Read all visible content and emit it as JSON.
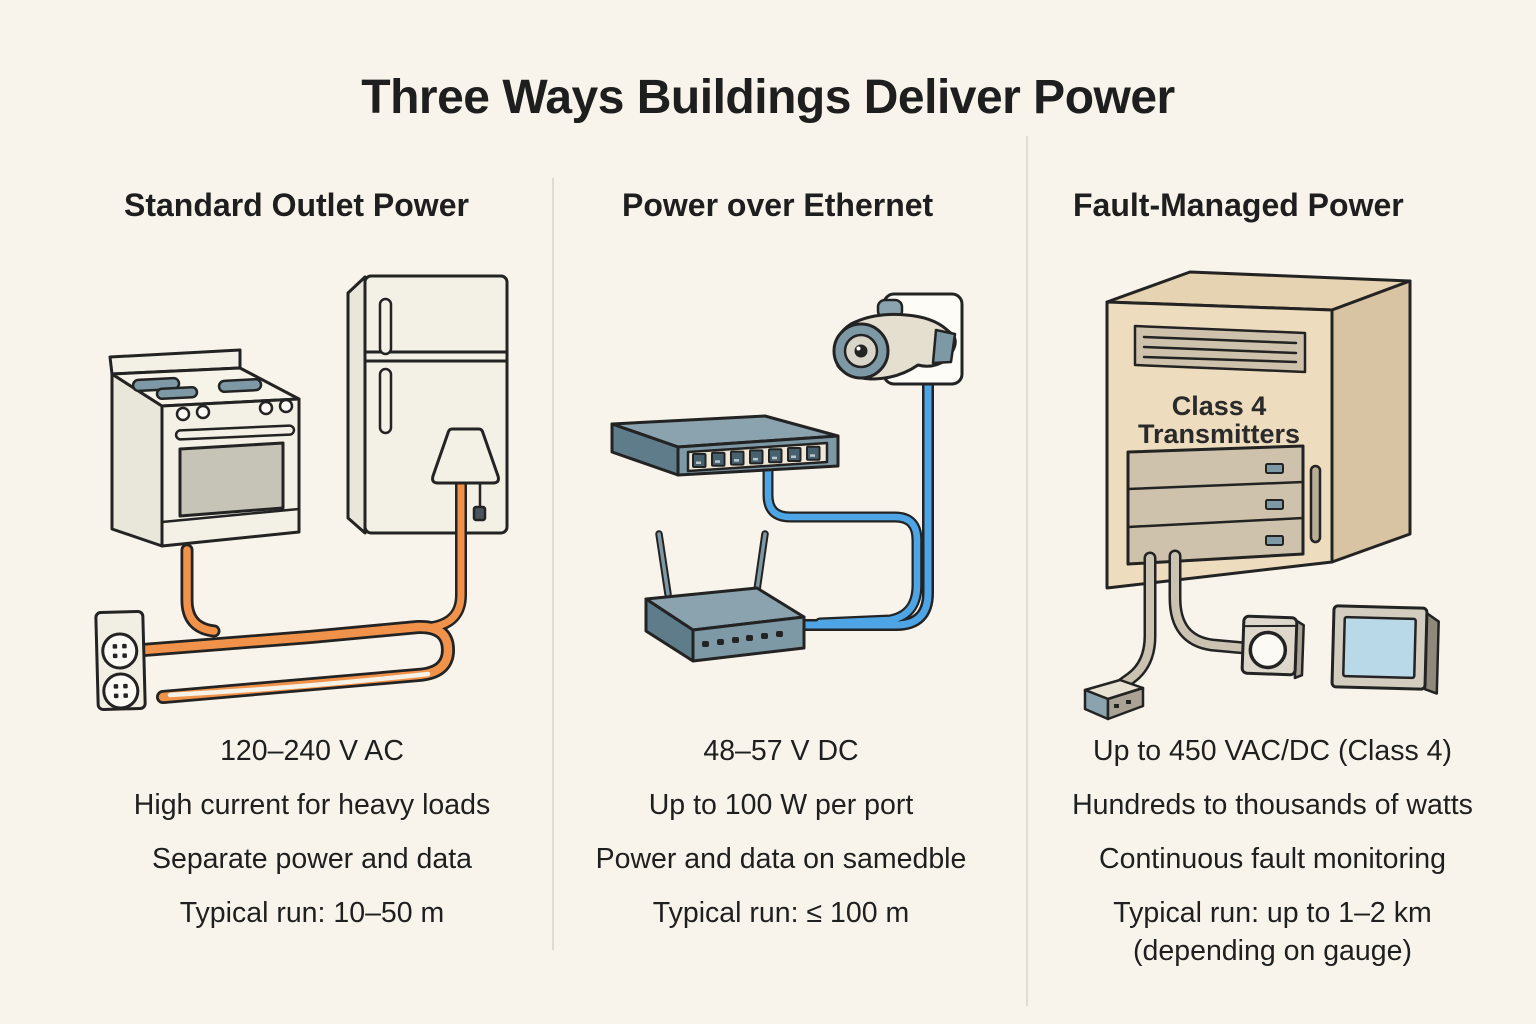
{
  "title": "Three Ways Buildings Deliver Power",
  "columns": [
    {
      "header": "Standard Outlet Power",
      "voltage": "120–240 V AC",
      "spec1": "High current for heavy loads",
      "spec2": "Separate power and data",
      "run": "Typical run: 10–50 m"
    },
    {
      "header": "Power over Ethernet",
      "voltage": "48–57 V DC",
      "spec1": "Up to 100 W per port",
      "spec2": "Power and data on samedble",
      "run": "Typical run: ≤ 100 m"
    },
    {
      "header": "Fault-Managed Power",
      "voltage": "Up to 450 VAC/DC (Class 4)",
      "spec1": "Hundreds to thousands of watts",
      "spec2": "Continuous fault monitoring",
      "run": "Typical run: up to 1–2 km",
      "run2": "(depending on gauge)"
    }
  ],
  "illustration_labels": {
    "cabinet_line1": "Class 4",
    "cabinet_line2": "Transmitters"
  },
  "icon_names": {
    "standard_outlet": [
      "stove-icon",
      "refrigerator-icon",
      "lamp-icon",
      "wall-outlet-icon",
      "power-cables"
    ],
    "poe": [
      "network-switch-icon",
      "router-icon",
      "security-camera-icon",
      "ethernet-cables"
    ],
    "fault_managed": [
      "transmitter-cabinet-icon",
      "plug-connector-icon",
      "dial-device-icon",
      "display-panel-icon",
      "fmp-cables"
    ]
  },
  "colors": {
    "background": "#F8F4EB",
    "ink": "#232323",
    "orange_cable": "#F0924A",
    "blue_cable": "#4EA5E5",
    "gray_cable": "#CBC3B2",
    "slate_device": "#7E99A6",
    "cabinet_tan": "#EDDDBE",
    "screen_blue": "#B9D8E8"
  }
}
